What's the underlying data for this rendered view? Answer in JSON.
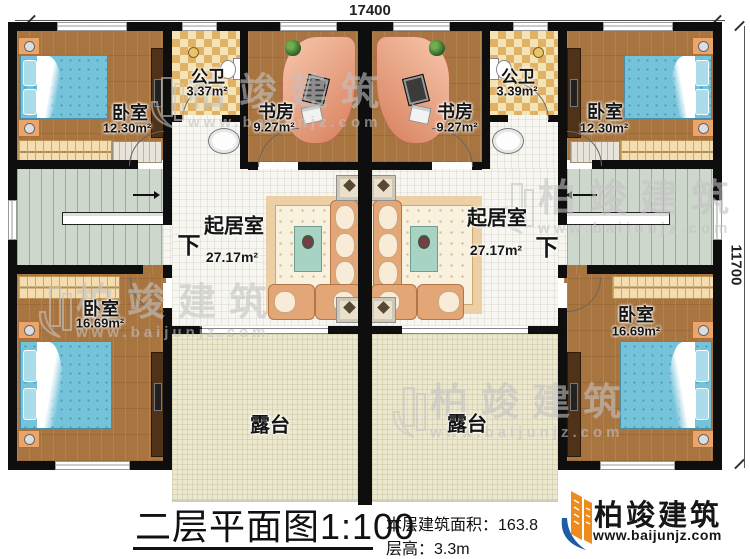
{
  "plan": {
    "dimensions": {
      "top": "17400",
      "right": "11700"
    },
    "stair_label": "下",
    "rooms": [
      {
        "id": "bedroom-top-left",
        "label": "卧室",
        "area": "12.30m²"
      },
      {
        "id": "bath-left",
        "label": "公卫",
        "area": "3.37m²"
      },
      {
        "id": "study-left",
        "label": "书房",
        "area": "9.27m²"
      },
      {
        "id": "study-right",
        "label": "书房",
        "area": "9.27m²"
      },
      {
        "id": "bath-right",
        "label": "公卫",
        "area": "3.39m²"
      },
      {
        "id": "bedroom-top-right",
        "label": "卧室",
        "area": "12.30m²"
      },
      {
        "id": "living-left",
        "label": "起居室",
        "area": "27.17m²"
      },
      {
        "id": "living-right",
        "label": "起居室",
        "area": "27.17m²"
      },
      {
        "id": "bedroom-bottom-left",
        "label": "卧室",
        "area": "16.69m²"
      },
      {
        "id": "bedroom-bottom-right",
        "label": "卧室",
        "area": "16.69m²"
      },
      {
        "id": "terrace-left",
        "label": "露台",
        "area": ""
      },
      {
        "id": "terrace-right",
        "label": "露台",
        "area": ""
      }
    ]
  },
  "watermark": {
    "text": "柏竣建筑",
    "website": "www.baijunjz.com"
  },
  "footer": {
    "plan_title": "二层平面图",
    "plan_scale": "1:100",
    "area_label": "本层建筑面积：",
    "area_value": "163.8",
    "floor_height_label": "层高：",
    "floor_height_value": "3.3m"
  },
  "logo": {
    "name": "柏竣建筑",
    "website": "www.baijunjz.com"
  },
  "colors": {
    "wall": "#0e0e0e",
    "wood": "#a87540",
    "terrace": "#ece7cf",
    "bed": "#74c3da",
    "logo_blue": "#1e5ca6",
    "logo_orange": "#ef8b1a"
  }
}
